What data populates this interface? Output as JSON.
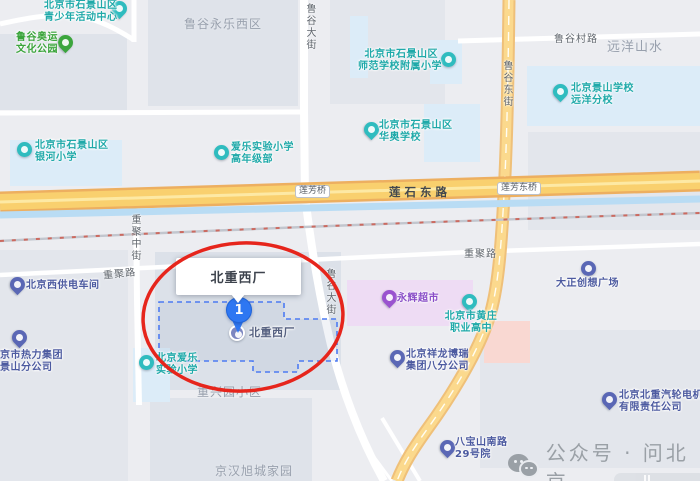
{
  "colors": {
    "background": "#ecedf1",
    "block": "#dfe3ea",
    "block2": "#e3e6ec",
    "factory_block": "#dce1e9",
    "school_area": "#dcecf8",
    "market_area": "#eedcf4",
    "pink_area": "#f9d8d2",
    "highway_casing": "#edaf60",
    "highway_fill": "#f9d06e",
    "highway_center": "#fde9a4",
    "road_yellow_casing": "#efc079",
    "road_yellow_fill": "#fbd98d",
    "river": "#b9dcf4",
    "railway_base": "#c2c6ce",
    "railway_dash": "#cc6a60",
    "boundary_blue": "#4d7bf2",
    "highlight_red": "#e6251c",
    "marker_blue": "#2e77f2",
    "poi_teal": "#2fbcbf",
    "poi_teal_text": "#1fa9a9",
    "poi_green": "#3ba53c",
    "poi_green_text": "#3aa43b",
    "poi_indigo": "#5a67b5",
    "poi_indigo_text": "#4c5aa0",
    "poi_purple": "#9a53cf",
    "poi_purple_text": "#8a4fc8",
    "poi_slate": "#7c86c0",
    "poi_slate_text": "#566180",
    "area_label": "#98a0ad",
    "road_label": "#5f656c",
    "road_label_dark": "#43484e",
    "watermark_gray": "#9aa0a6"
  },
  "highlight": {
    "callout": "北重西厂",
    "marker_number": "1"
  },
  "watermark": {
    "text": "公众号 · 问北京"
  },
  "map": {
    "pois": [
      {
        "id": "youth-center",
        "shape": "pin",
        "color": "teal",
        "ix": 112,
        "iy": 1,
        "lx": 44,
        "ly": 0,
        "align": "left",
        "lines": [
          "北京市石景山区",
          "青少年活动中心"
        ]
      },
      {
        "id": "lugu-olympic-park",
        "shape": "pin",
        "color": "green",
        "ix": 58,
        "iy": 35,
        "lx": 16,
        "ly": 32,
        "align": "left",
        "lines": [
          "鲁谷奥运",
          "文化公园"
        ]
      },
      {
        "id": "yinhe-primary-school",
        "shape": "badge",
        "color": "teal",
        "ix": 17,
        "iy": 142,
        "lx": 35,
        "ly": 140,
        "align": "left",
        "lines": [
          "北京市石景山区",
          "银河小学"
        ]
      },
      {
        "id": "aiyue-experimental-senior",
        "shape": "badge",
        "color": "teal",
        "ix": 214,
        "iy": 145,
        "lx": 231,
        "ly": 142,
        "align": "left",
        "lines": [
          "爱乐实验小学",
          "高年级部"
        ]
      },
      {
        "id": "shifan-affiliated-primary",
        "shape": "badge",
        "color": "teal",
        "ix": 441,
        "iy": 52,
        "lx": 358,
        "ly": 49,
        "align": "right",
        "w": 80,
        "lines": [
          "北京市石景山区",
          "师范学校附属小学"
        ]
      },
      {
        "id": "jingshan-yuanyang-school",
        "shape": "pin",
        "color": "teal",
        "ix": 553,
        "iy": 84,
        "lx": 571,
        "ly": 83,
        "align": "left",
        "lines": [
          "北京景山学校",
          "远洋分校"
        ]
      },
      {
        "id": "huaao-school",
        "shape": "pin",
        "color": "teal",
        "ix": 364,
        "iy": 122,
        "lx": 379,
        "ly": 120,
        "align": "left",
        "lines": [
          "北京市石景山区",
          "华奥学校"
        ]
      },
      {
        "id": "huangzhuang-vocational",
        "shape": "pin",
        "color": "teal",
        "ix": 462,
        "iy": 294,
        "lx": 444,
        "ly": 311,
        "align": "center",
        "w": 54,
        "lines": [
          "北京市黄庄",
          "职业高中"
        ]
      },
      {
        "id": "aiyue-experimental-primary",
        "shape": "badge",
        "color": "teal",
        "ix": 139,
        "iy": 355,
        "lx": 156,
        "ly": 353,
        "align": "left",
        "lines": [
          "北京爱乐",
          "实验小学"
        ]
      },
      {
        "id": "west-power-depot",
        "shape": "pin",
        "color": "indigo",
        "ix": 10,
        "iy": 277,
        "lx": 26,
        "ly": 280,
        "align": "left",
        "lines": [
          "北京西供电车间"
        ]
      },
      {
        "id": "dazheng-plaza",
        "shape": "badge",
        "color": "indigo",
        "ix": 581,
        "iy": 261,
        "lx": 556,
        "ly": 278,
        "align": "left",
        "lines": [
          "大正创想广场"
        ]
      },
      {
        "id": "thermal-group-branch",
        "shape": "pin",
        "color": "indigo",
        "ix": 12,
        "iy": 330,
        "lx": 0,
        "ly": 350,
        "align": "left",
        "lines": [
          "京市热力集团",
          "景山分公司"
        ]
      },
      {
        "id": "xianglong-branch",
        "shape": "pin",
        "color": "indigo",
        "ix": 390,
        "iy": 350,
        "lx": 406,
        "ly": 349,
        "align": "left",
        "lines": [
          "北京祥龙博瑞",
          "集团八分公司"
        ]
      },
      {
        "id": "turbine-electric-company",
        "shape": "pin",
        "color": "indigo",
        "ix": 602,
        "iy": 392,
        "lx": 619,
        "ly": 390,
        "align": "left",
        "lines": [
          "北京北重汽轮电机",
          "有限责任公司"
        ]
      },
      {
        "id": "babaoshan-yard-29",
        "shape": "pin",
        "color": "indigo",
        "ix": 440,
        "iy": 440,
        "lx": 455,
        "ly": 437,
        "align": "left",
        "lines": [
          "八宝山南路",
          "29号院"
        ]
      },
      {
        "id": "yonghui-supermarket",
        "shape": "pin",
        "color": "purple",
        "ix": 382,
        "iy": 290,
        "lx": 397,
        "ly": 293,
        "align": "left",
        "lines": [
          "永辉超市"
        ]
      },
      {
        "id": "beizhong-west-plant",
        "shape": "badge-big",
        "color": "slate",
        "ix": 229,
        "iy": 325,
        "lx": 249,
        "ly": 327,
        "align": "left",
        "size": 11,
        "lines": [
          "北重西厂"
        ]
      }
    ],
    "area_labels": [
      {
        "text": "鲁谷永乐西区",
        "x": 184,
        "y": 15,
        "size": 12
      },
      {
        "text": "远洋山水",
        "x": 607,
        "y": 36,
        "size": 13
      },
      {
        "text": "重兴园小区",
        "x": 197,
        "y": 383,
        "size": 12
      },
      {
        "text": "京汉旭城家园",
        "x": 215,
        "y": 462,
        "size": 12
      }
    ],
    "road_labels": [
      {
        "text": "鲁谷大街",
        "x": 302,
        "y": 3,
        "kind": "v"
      },
      {
        "text": "鲁谷大街",
        "x": 322,
        "y": 268,
        "kind": "v"
      },
      {
        "text": "鲁谷东街",
        "x": 499,
        "y": 60,
        "kind": "v"
      },
      {
        "text": "重聚中街",
        "x": 127,
        "y": 214,
        "kind": "v"
      },
      {
        "text": "重聚路",
        "x": 103,
        "y": 265,
        "kind": "h",
        "rot": -6
      },
      {
        "text": "重聚路",
        "x": 464,
        "y": 245,
        "kind": "h"
      },
      {
        "text": "鲁谷村路",
        "x": 554,
        "y": 30,
        "kind": "h"
      },
      {
        "text": "莲石东路",
        "x": 389,
        "y": 184,
        "kind": "major"
      },
      {
        "text": "莲芳桥",
        "x": 295,
        "y": 185,
        "kind": "pill"
      },
      {
        "text": "莲芳东桥",
        "x": 497,
        "y": 182,
        "kind": "pill"
      }
    ]
  }
}
